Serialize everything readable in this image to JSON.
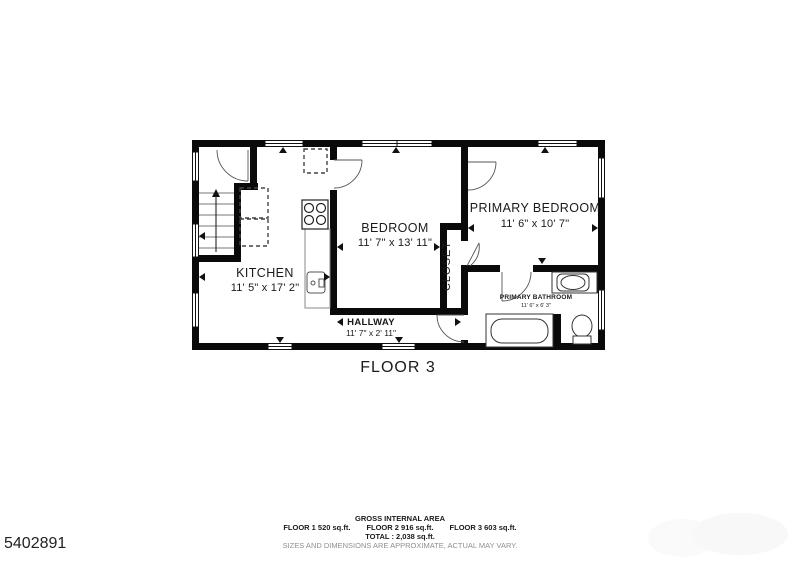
{
  "floor_plan": {
    "title": "FLOOR 3",
    "rooms": [
      {
        "name": "KITCHEN",
        "dimensions": "11' 5\" x 17' 2\""
      },
      {
        "name": "BEDROOM",
        "dimensions": "11' 7\" x 13' 11\""
      },
      {
        "name": "PRIMARY BEDROOM",
        "dimensions": "11' 6\" x 10' 7\""
      },
      {
        "name": "CLOSET",
        "dimensions": ""
      },
      {
        "name": "HALLWAY",
        "dimensions": "11' 7\" x 2' 11\""
      },
      {
        "name": "PRIMARY BATHROOM",
        "dimensions": "11' 6\" x 6' 3\""
      }
    ]
  },
  "footer": {
    "gross_area_title": "GROSS INTERNAL AREA",
    "floor_1_area": "FLOOR 1 520 sq.ft.",
    "floor_2_area": "FLOOR 2 916 sq.ft.",
    "floor_3_area": "FLOOR 3 603 sq.ft.",
    "total": "TOTAL : 2,038 sq.ft.",
    "disclaimer": "SIZES AND DIMENSIONS ARE APPROXIMATE, ACTUAL MAY VARY."
  },
  "listing_id": "5402891",
  "colors": {
    "wall": "#0a0a0a",
    "text": "#1a1a1a",
    "disclaimer_text": "#8f8f8f",
    "background": "#ffffff"
  }
}
